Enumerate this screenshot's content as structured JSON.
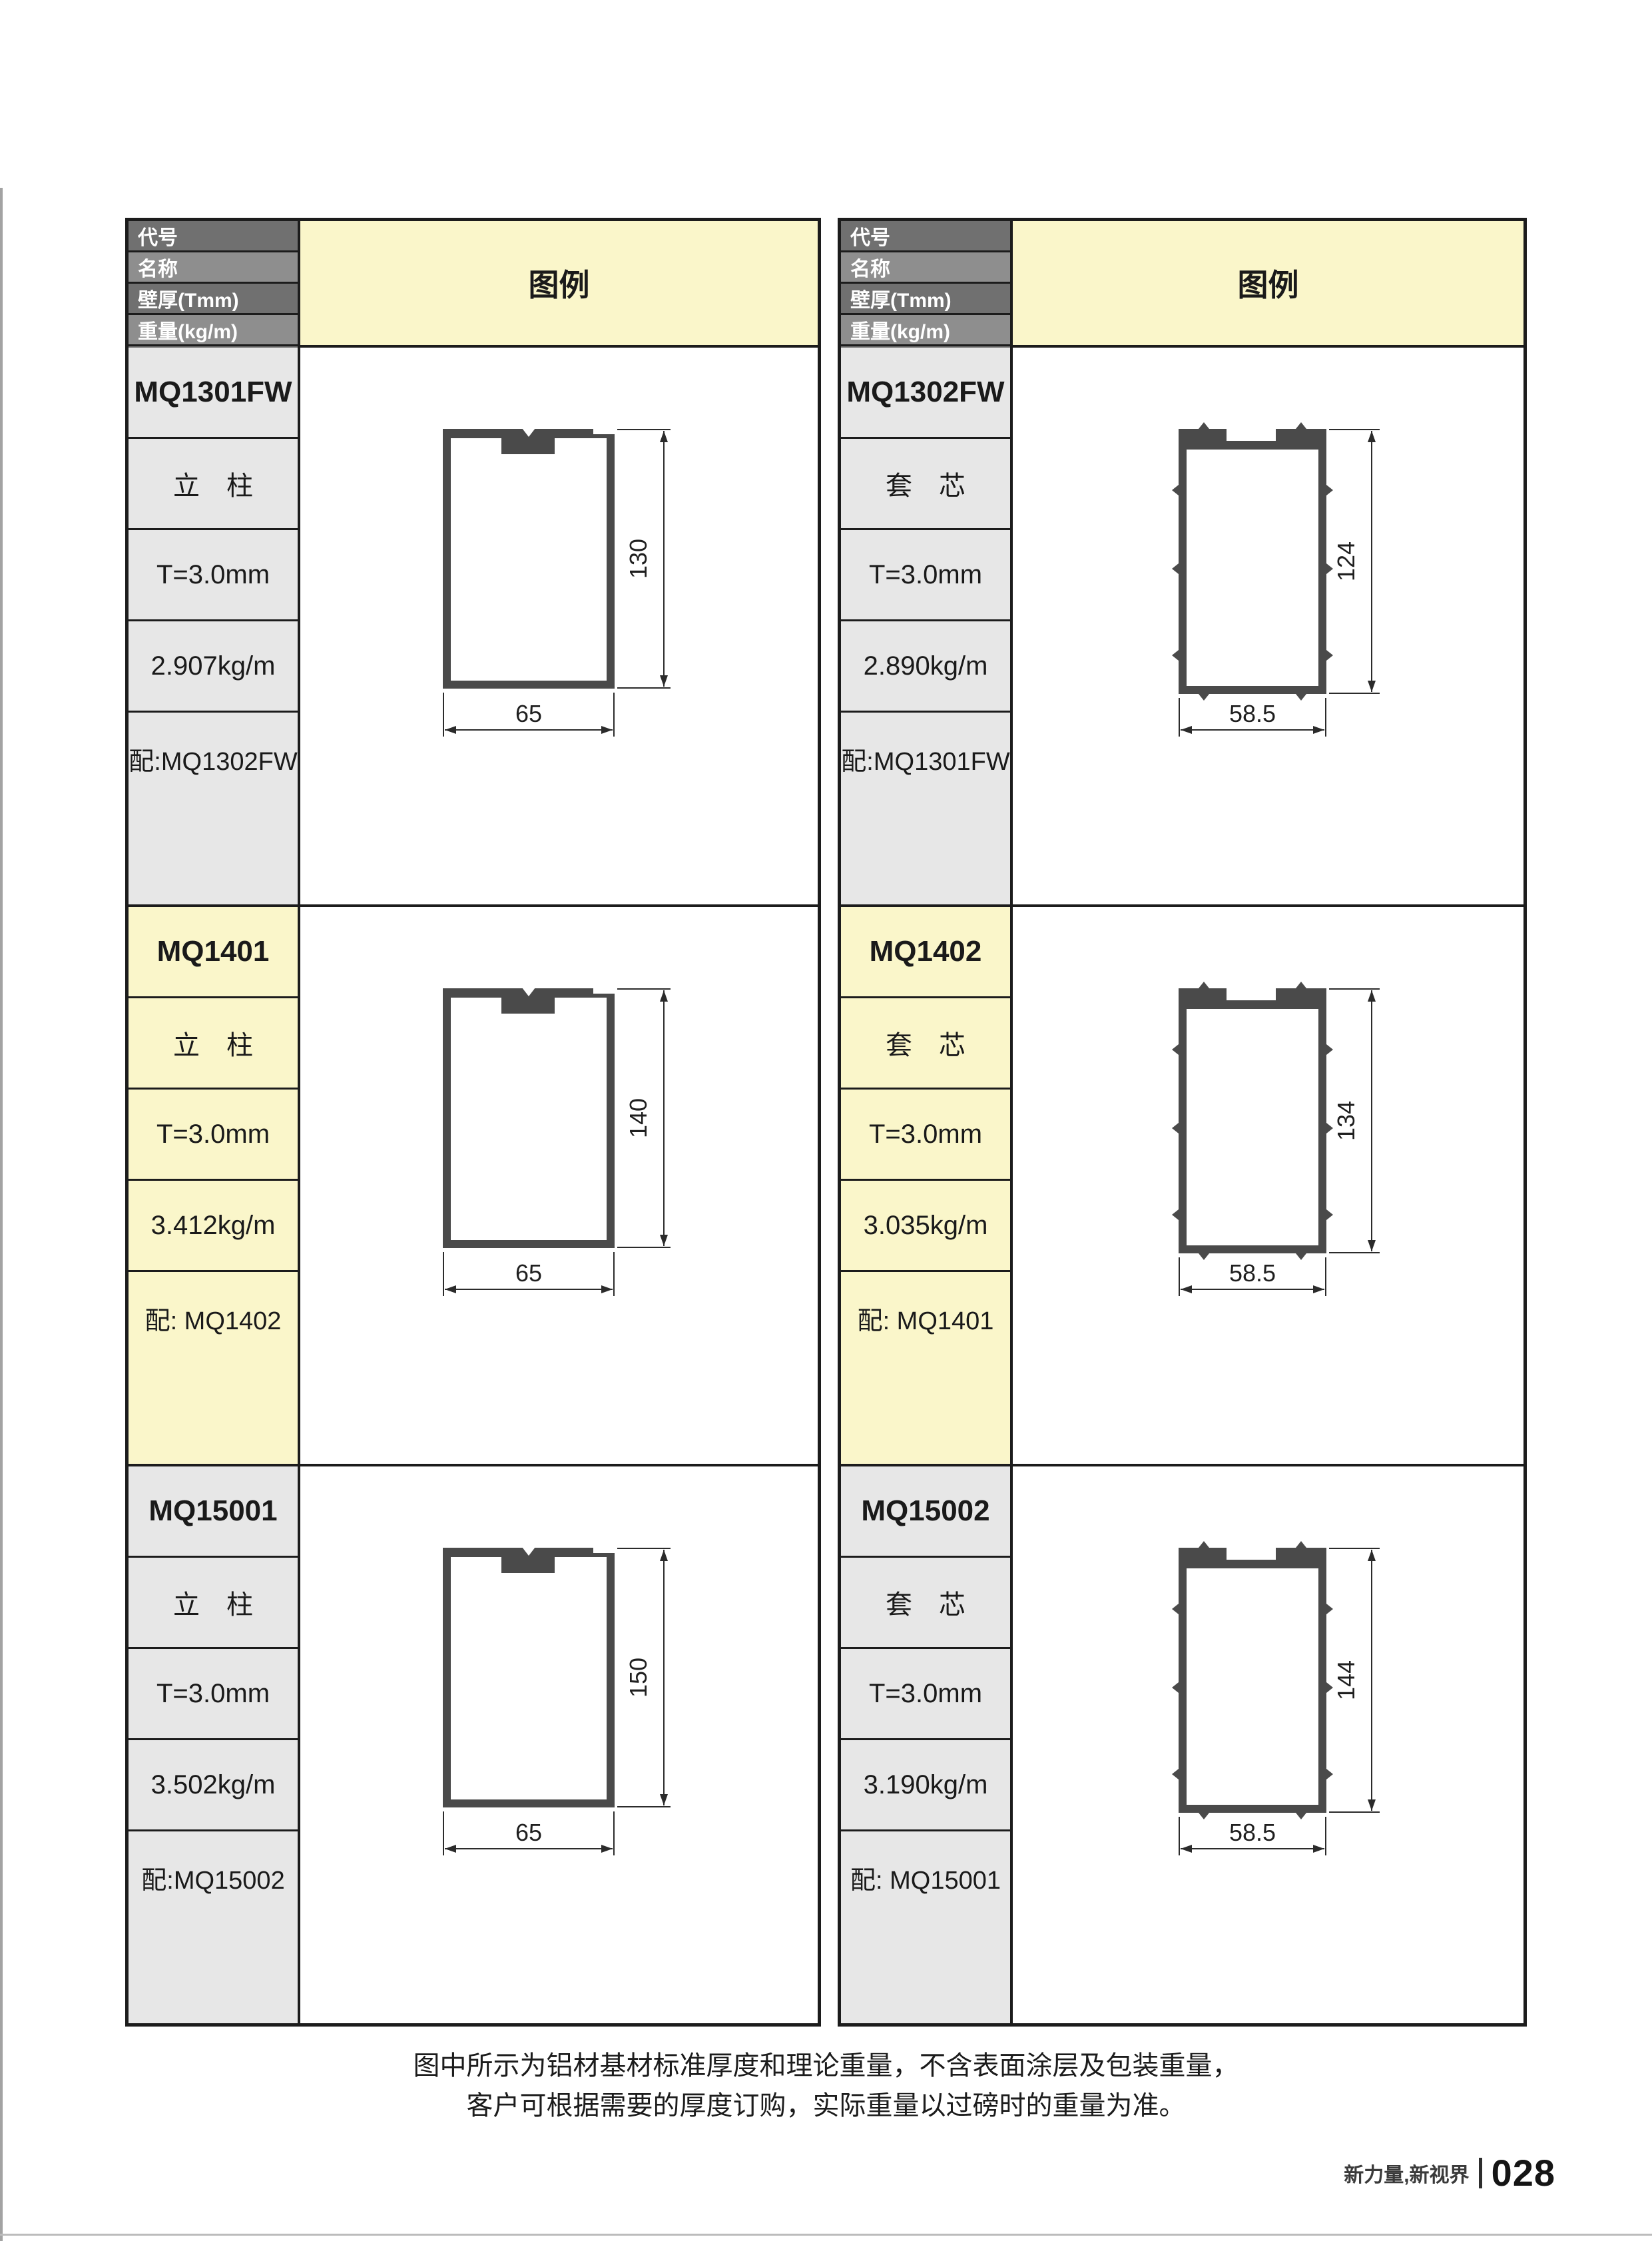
{
  "legend_label": "图例",
  "header_labels": [
    "代号",
    "名称",
    "壁厚(Tmm)",
    "重量(kg/m)",
    "配套"
  ],
  "colors": {
    "legend_bg": "#FAF6CA",
    "highlight_section_bg": "#FAF6CA",
    "label_cell_bg": "#E7E7E7",
    "header_row_dark": "#707070",
    "header_row_light": "#8E8E8E",
    "border": "#1C1C1C",
    "profile_wall": "#4A4A4A",
    "dimension_line": "#2B2B2B"
  },
  "tables": [
    {
      "sections": [
        {
          "code": "MQ1301FW",
          "name": "立　柱",
          "thickness": "T=3.0mm",
          "weight": "2.907kg/m",
          "match": "配:MQ1302FW",
          "highlight": false,
          "diagram": {
            "type": "column",
            "height_label": "130",
            "width_label": "65"
          }
        },
        {
          "code": "MQ1401",
          "name": "立　柱",
          "thickness": "T=3.0mm",
          "weight": "3.412kg/m",
          "match": "配: MQ1402",
          "highlight": true,
          "diagram": {
            "type": "column",
            "height_label": "140",
            "width_label": "65"
          }
        },
        {
          "code": "MQ15001",
          "name": "立　柱",
          "thickness": "T=3.0mm",
          "weight": "3.502kg/m",
          "match": "配:MQ15002",
          "highlight": false,
          "diagram": {
            "type": "column",
            "height_label": "150",
            "width_label": "65"
          }
        }
      ]
    },
    {
      "sections": [
        {
          "code": "MQ1302FW",
          "name": "套　芯",
          "thickness": "T=3.0mm",
          "weight": "2.890kg/m",
          "match": "配:MQ1301FW",
          "highlight": false,
          "diagram": {
            "type": "core",
            "height_label": "124",
            "width_label": "58.5"
          }
        },
        {
          "code": "MQ1402",
          "name": "套　芯",
          "thickness": "T=3.0mm",
          "weight": "3.035kg/m",
          "match": "配: MQ1401",
          "highlight": true,
          "diagram": {
            "type": "core",
            "height_label": "134",
            "width_label": "58.5"
          }
        },
        {
          "code": "MQ15002",
          "name": "套　芯",
          "thickness": "T=3.0mm",
          "weight": "3.190kg/m",
          "match": "配: MQ15001",
          "highlight": false,
          "diagram": {
            "type": "core",
            "height_label": "144",
            "width_label": "58.5"
          }
        }
      ]
    }
  ],
  "page": {
    "footer_note_line1": "图中所示为铝材基材标准厚度和理论重量，不含表面涂层及包装重量，",
    "footer_note_line2": "客户可根据需要的厚度订购，实际重量以过磅时的重量为准。",
    "footer_brand": "新力量,新视界",
    "footer_page_number": "028"
  }
}
